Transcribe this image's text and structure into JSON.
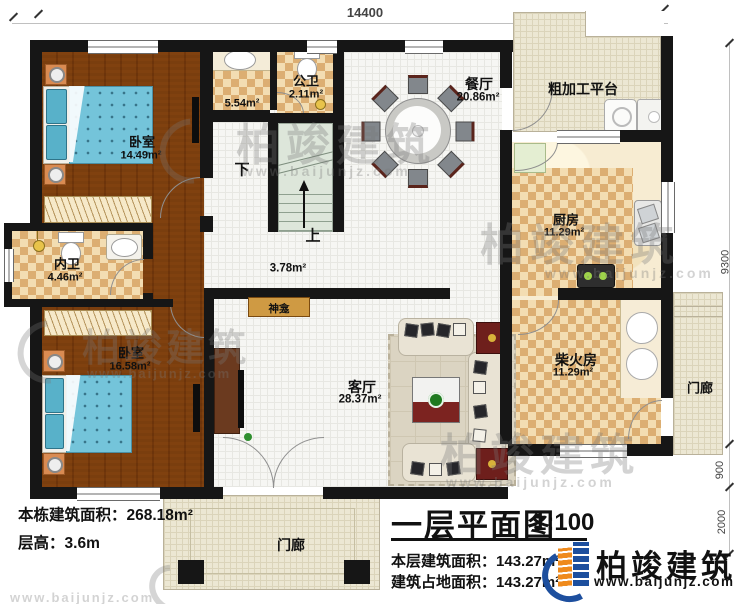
{
  "dimensions": {
    "top": "14400",
    "right_upper": "9300",
    "right_mid": "900",
    "right_lower": "2000"
  },
  "rooms": {
    "bedroom1": {
      "name": "卧室",
      "area": "14.49m²"
    },
    "bath_hall": {
      "area": "5.54m²"
    },
    "public_bath": {
      "name": "公卫",
      "area": "2.11m²"
    },
    "dining": {
      "name": "餐厅",
      "area": "20.86m²"
    },
    "platform": {
      "name": "粗加工平台"
    },
    "kitchen": {
      "name": "厨房",
      "area": "11.29m²"
    },
    "private_bath": {
      "name": "内卫",
      "area": "4.46m²"
    },
    "bedroom2": {
      "name": "卧室",
      "area": "16.58m²"
    },
    "living": {
      "name": "客厅",
      "area": "28.37m²"
    },
    "firewood": {
      "name": "柴火房",
      "area": "11.29m²"
    },
    "hall": {
      "area": "3.78m²"
    },
    "shrine": {
      "name": "神龛"
    },
    "porch_right": {
      "name": "门廊"
    },
    "porch_bottom": {
      "name": "门廊"
    }
  },
  "stairs": {
    "down": "下",
    "up": "上"
  },
  "info": {
    "building_area_label": "本栋建筑面积：",
    "building_area_value": "268.18m²",
    "height_label": "层高：",
    "height_value": "3.6m"
  },
  "title_block": {
    "title": "一层平面图",
    "scale": "1:100",
    "floor_area_label": "本层建筑面积：",
    "floor_area_value": "143.27m²",
    "footprint_label": "建筑占地面积：",
    "footprint_value": "143.27m²"
  },
  "brand": {
    "name": "柏竣建筑",
    "url": "www.baijunjz.com"
  },
  "watermark": {
    "name": "柏竣建筑",
    "url": "www.baijunjz.com"
  },
  "colors": {
    "wall": "#161616",
    "wood": "#b5813e",
    "tile": "#dcae72",
    "brand_blue": "#1d4f9e",
    "brand_orange": "#ef8a1c"
  }
}
